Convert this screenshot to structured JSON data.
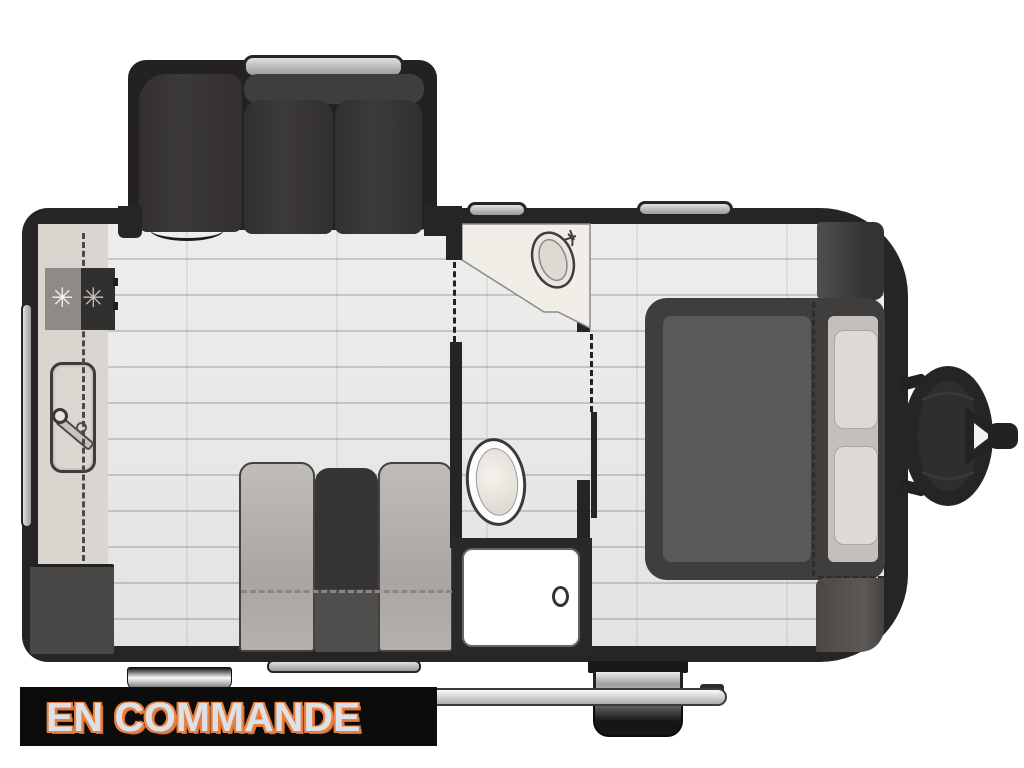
{
  "banner": {
    "label": "EN COMMANDE",
    "background_color": "#0c0c0c",
    "text_fill_color": "#dde0e6",
    "text_outline_color": "#e8813f"
  },
  "floorplan": {
    "type": "travel-trailer-top-view",
    "wall_color": "#262424",
    "floor_color": "#e9e9e8",
    "fixtures": [
      "slide-out-theater-seating",
      "kitchen-counter",
      "kitchen-cooktop",
      "kitchen-sink",
      "refrigerator-cabinet",
      "dinette-bench-left",
      "dinette-table",
      "dinette-bench-right",
      "bathroom-vanity-sink",
      "toilet",
      "shower",
      "wardrobe",
      "bed",
      "pillows",
      "corner-cabinet",
      "entry-step",
      "wheel",
      "awning-rail",
      "propane-tank-hitch"
    ],
    "windows": [
      "slide-out-window",
      "top-window-1",
      "top-window-2",
      "left-window",
      "bottom-window"
    ]
  }
}
